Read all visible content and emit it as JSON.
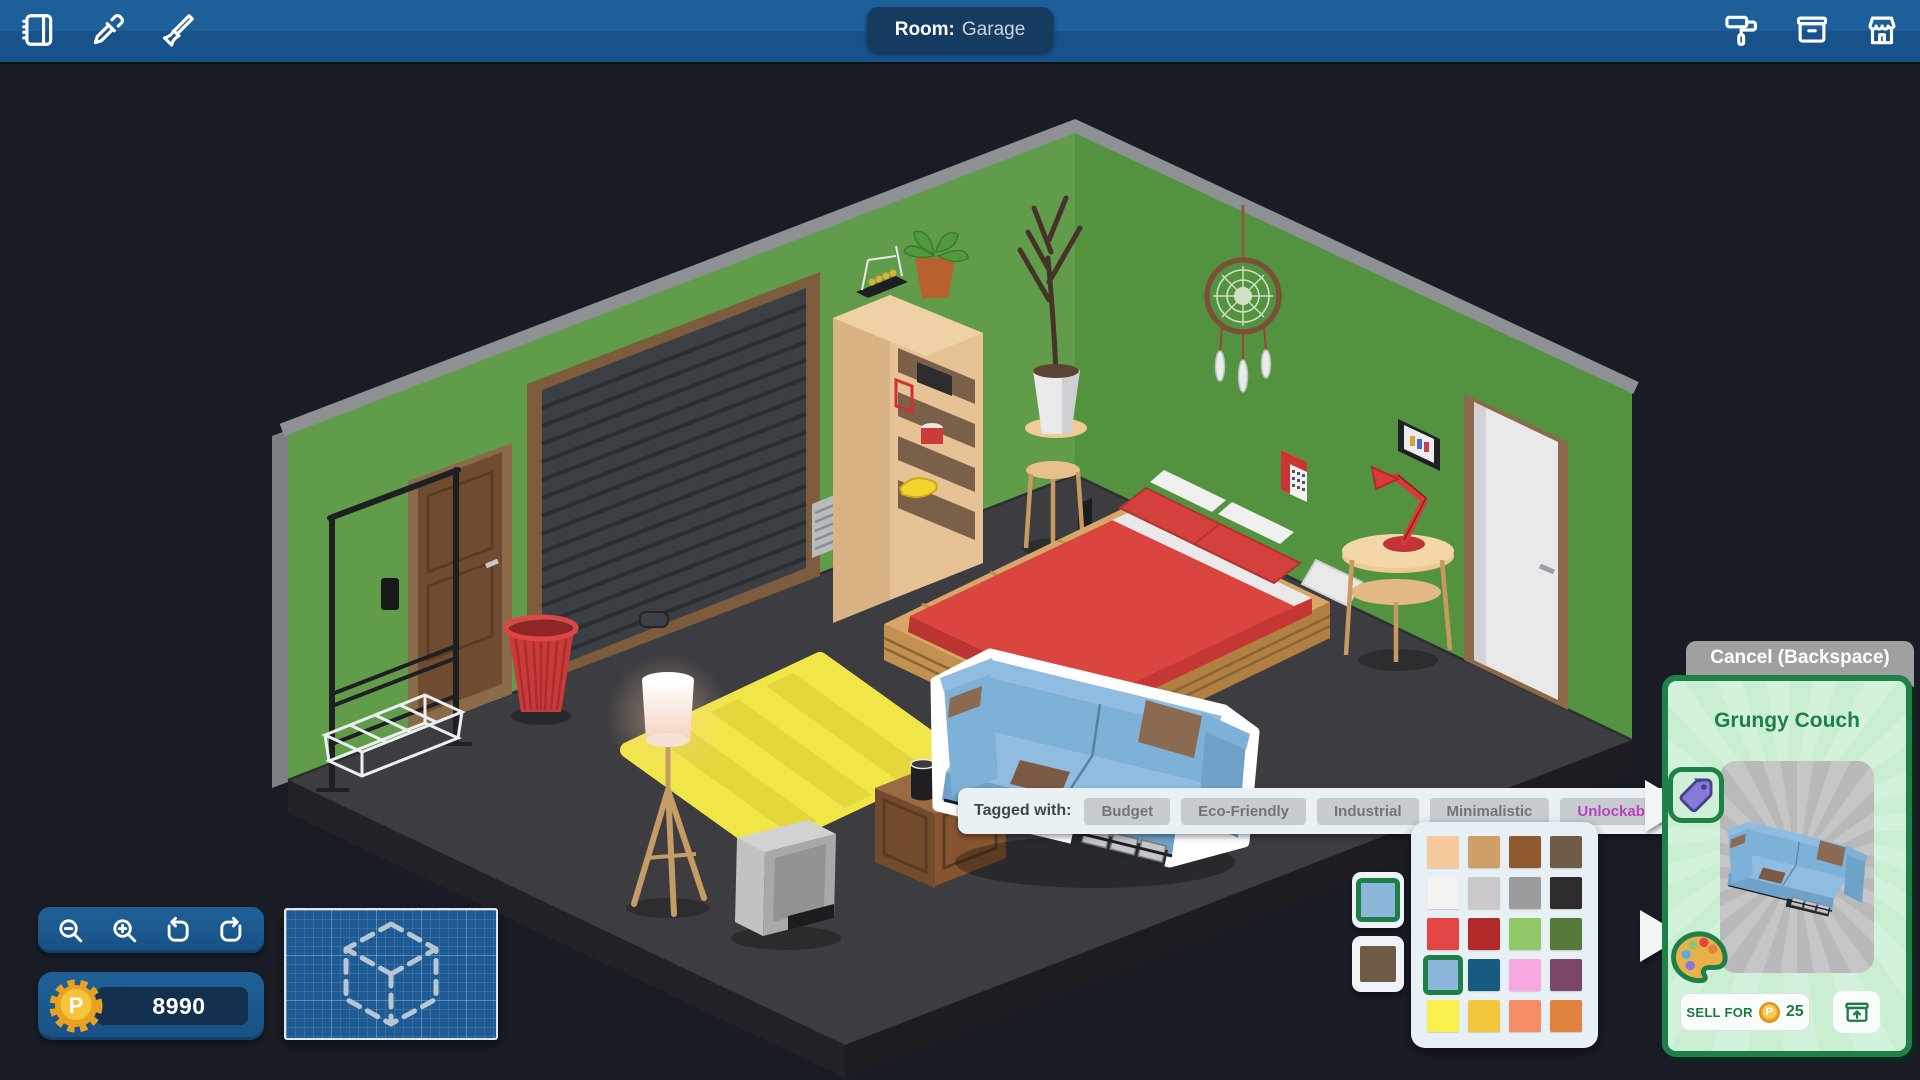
{
  "top_bar": {
    "room_label": "Room:",
    "room_name": "Garage",
    "left_icons": [
      "catalog-icon",
      "eyedropper-icon",
      "paintbrush-icon"
    ],
    "right_icons": [
      "paint-roller-icon",
      "storage-box-icon",
      "shop-icon"
    ]
  },
  "tag_bar": {
    "label": "Tagged with:",
    "tags": [
      {
        "label": "Budget",
        "highlight": false
      },
      {
        "label": "Eco-Friendly",
        "highlight": false
      },
      {
        "label": "Industrial",
        "highlight": false
      },
      {
        "label": "Minimalistic",
        "highlight": false
      },
      {
        "label": "Unlockables",
        "highlight": true
      }
    ],
    "highlight_color": "#bc3fbe"
  },
  "item_panel": {
    "cancel_label": "Cancel (Backspace)",
    "item_name": "Grungy Couch",
    "sell_label": "SELL FOR",
    "sell_price": "25",
    "coin_letter": "P",
    "accent_green": "#1f8048"
  },
  "hud": {
    "balance": "8990",
    "coin_letter": "P",
    "toolbar_icons": [
      "zoom-out-icon",
      "zoom-in-icon",
      "rotate-ccw-icon",
      "rotate-cw-icon"
    ],
    "coin_gold": "#eda723"
  },
  "palette": {
    "colors": [
      "#f5c99b",
      "#cf9d66",
      "#8f5a2e",
      "#6f5a45",
      "#f4f1f1",
      "#cac8c8",
      "#9c9c9c",
      "#2e2c2c",
      "#e34444",
      "#b32929",
      "#90c867",
      "#567a39",
      "#8cb6da",
      "#175b80",
      "#f7a8de",
      "#7c4767",
      "#f8f04b",
      "#f3c63e",
      "#f58e66",
      "#e2823f"
    ],
    "selected_index": 12,
    "selected_border": "#1e8048",
    "slots": [
      {
        "color": "#8cb6da",
        "selected": true
      },
      {
        "color": "#6f5a45",
        "selected": false
      }
    ]
  },
  "colors": {
    "topbar_blue": "#1d5f99",
    "wall_green_left": "#609c4a",
    "wall_green_right": "#539340",
    "floor_gray": "#3c3c41",
    "panel_mint": "#cdf0d6",
    "couch_blue": "#7db1d7"
  }
}
